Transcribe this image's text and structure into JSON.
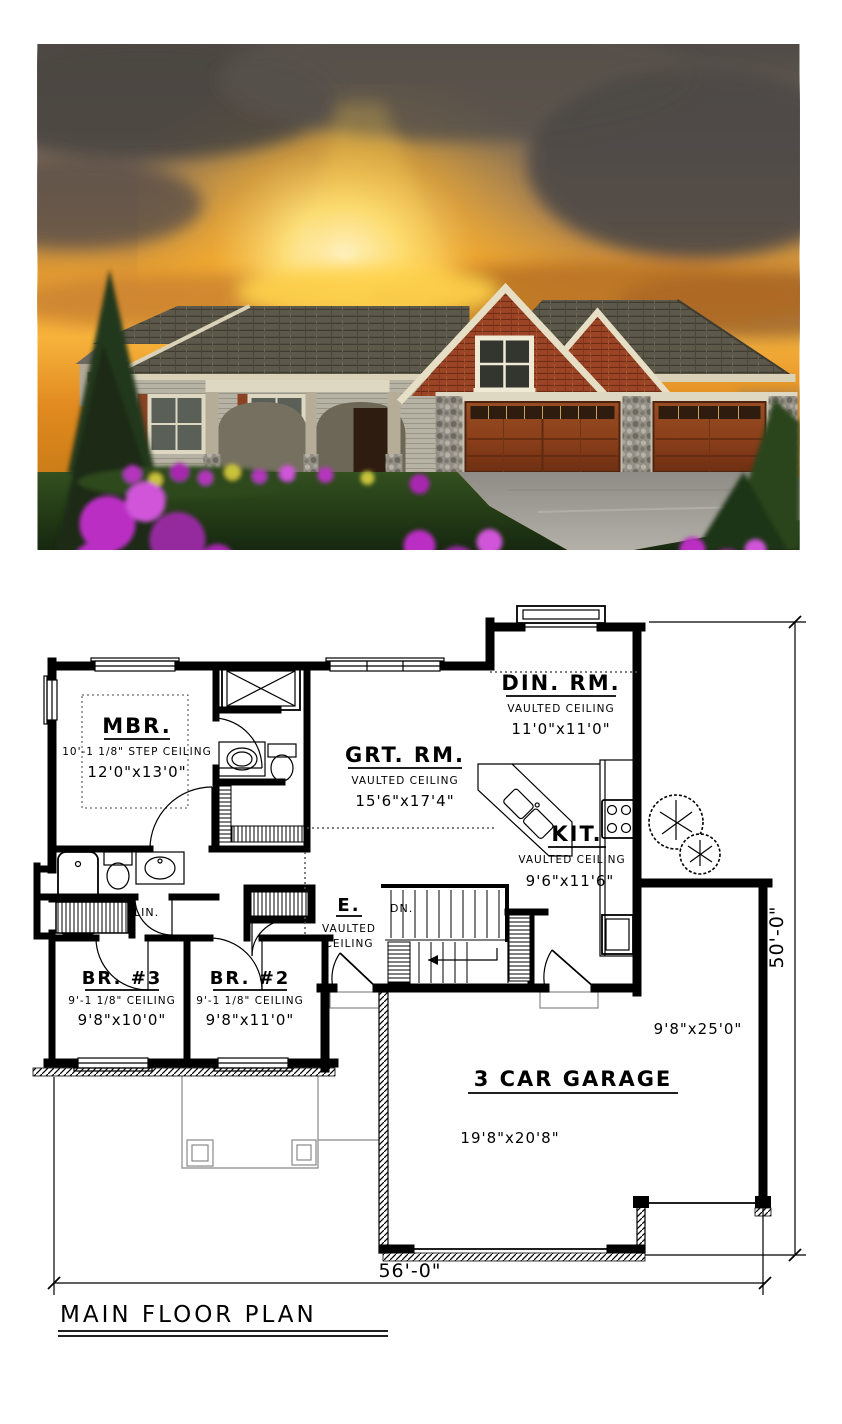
{
  "photo": {
    "description": "Craftsman ranch house exterior rendering at sunset with 3-car garage",
    "colors": {
      "sky_glow": "#ffd34d",
      "clouds": "#4e4945",
      "roof": "#5c584a",
      "gable_shakes": "#9c4526",
      "siding": "#b7b3a4",
      "trim": "#ded8c2",
      "garage_door": "#8a4420",
      "stone": "#948f85",
      "lawn": "#2c471c",
      "driveway": "#a5a39d",
      "flowers": "#bb2fc4"
    }
  },
  "plan": {
    "title": "MAIN FLOOR PLAN",
    "overall_width": "56'-0\"",
    "overall_depth": "50'-0\"",
    "rooms": {
      "mbr": {
        "name": "MBR.",
        "ceiling": "10'-1 1/8\" STEP CEILING",
        "size": "12'0\"x13'0\""
      },
      "grt": {
        "name": "GRT. RM.",
        "ceiling": "VAULTED CEILING",
        "size": "15'6\"x17'4\""
      },
      "din": {
        "name": "DIN. RM.",
        "ceiling": "VAULTED CEILING",
        "size": "11'0\"x11'0\""
      },
      "kit": {
        "name": "KIT.",
        "ceiling": "VAULTED CEILING",
        "size": "9'6\"x11'6\""
      },
      "entry": {
        "name": "E.",
        "ceiling_line1": "VAULTED",
        "ceiling_line2": "CEILING"
      },
      "br3": {
        "name": "BR. #3",
        "ceiling": "9'-1 1/8\" CEILING",
        "size": "9'8\"x10'0\""
      },
      "br2": {
        "name": "BR. #2",
        "ceiling": "9'-1 1/8\" CEILING",
        "size": "9'8\"x11'0\""
      },
      "garage": {
        "name": "3 CAR GARAGE",
        "size": "19'8\"x20'8\"",
        "bay_size": "9'8\"x25'0\""
      }
    },
    "labels": {
      "stairs": "DN.",
      "linen": "LIN."
    }
  }
}
